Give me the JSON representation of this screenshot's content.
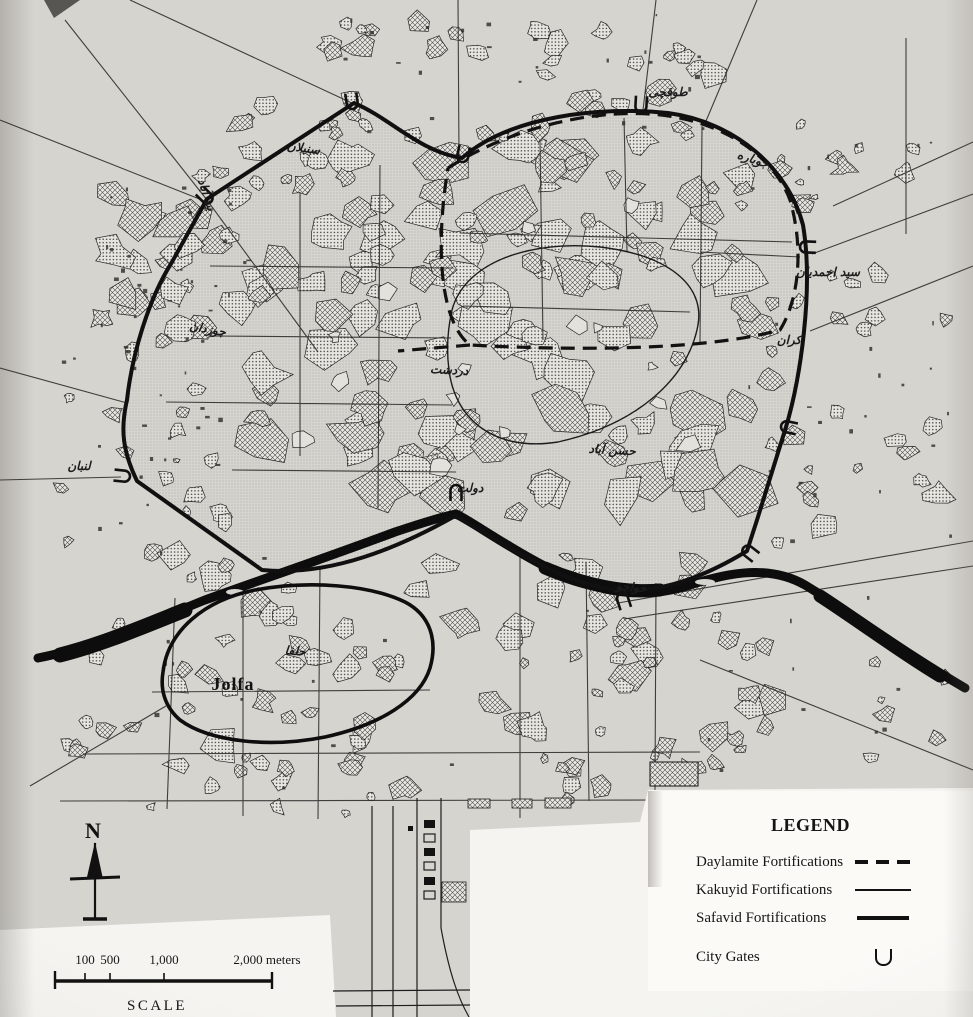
{
  "legend": {
    "title": "LEGEND",
    "items": [
      {
        "label": "Daylamite Fortifications",
        "symbol": "dashed-line"
      },
      {
        "label": "Kakuyid Fortifications",
        "symbol": "thin-line"
      },
      {
        "label": "Safavid Fortifications",
        "symbol": "thick-line"
      },
      {
        "label": "City Gates",
        "symbol": "gate-u-glyph"
      }
    ]
  },
  "scale": {
    "tick_100": "100",
    "tick_500": "500",
    "tick_1000": "1,000",
    "tick_2000": "2,000 meters",
    "caption": "SCALE"
  },
  "compass": {
    "north_label": "N"
  },
  "map": {
    "jolfa_label": "Jolfa",
    "labels": [
      {
        "text": "بید آباد"
      },
      {
        "text": "سنبلان"
      },
      {
        "text": "جوباره"
      },
      {
        "text": "طوقچی"
      },
      {
        "text": "سید احمدیان"
      },
      {
        "text": "جوزدان"
      },
      {
        "text": "دردشت"
      },
      {
        "text": "کران"
      },
      {
        "text": "حسن آباد"
      },
      {
        "text": "لنبان"
      },
      {
        "text": "خواجو"
      },
      {
        "text": "دولت"
      },
      {
        "text": "حلفا"
      }
    ]
  },
  "colors": {
    "paper": "#d6d4cf",
    "ink": "#141414",
    "white_panel": "#f5f4f0"
  }
}
